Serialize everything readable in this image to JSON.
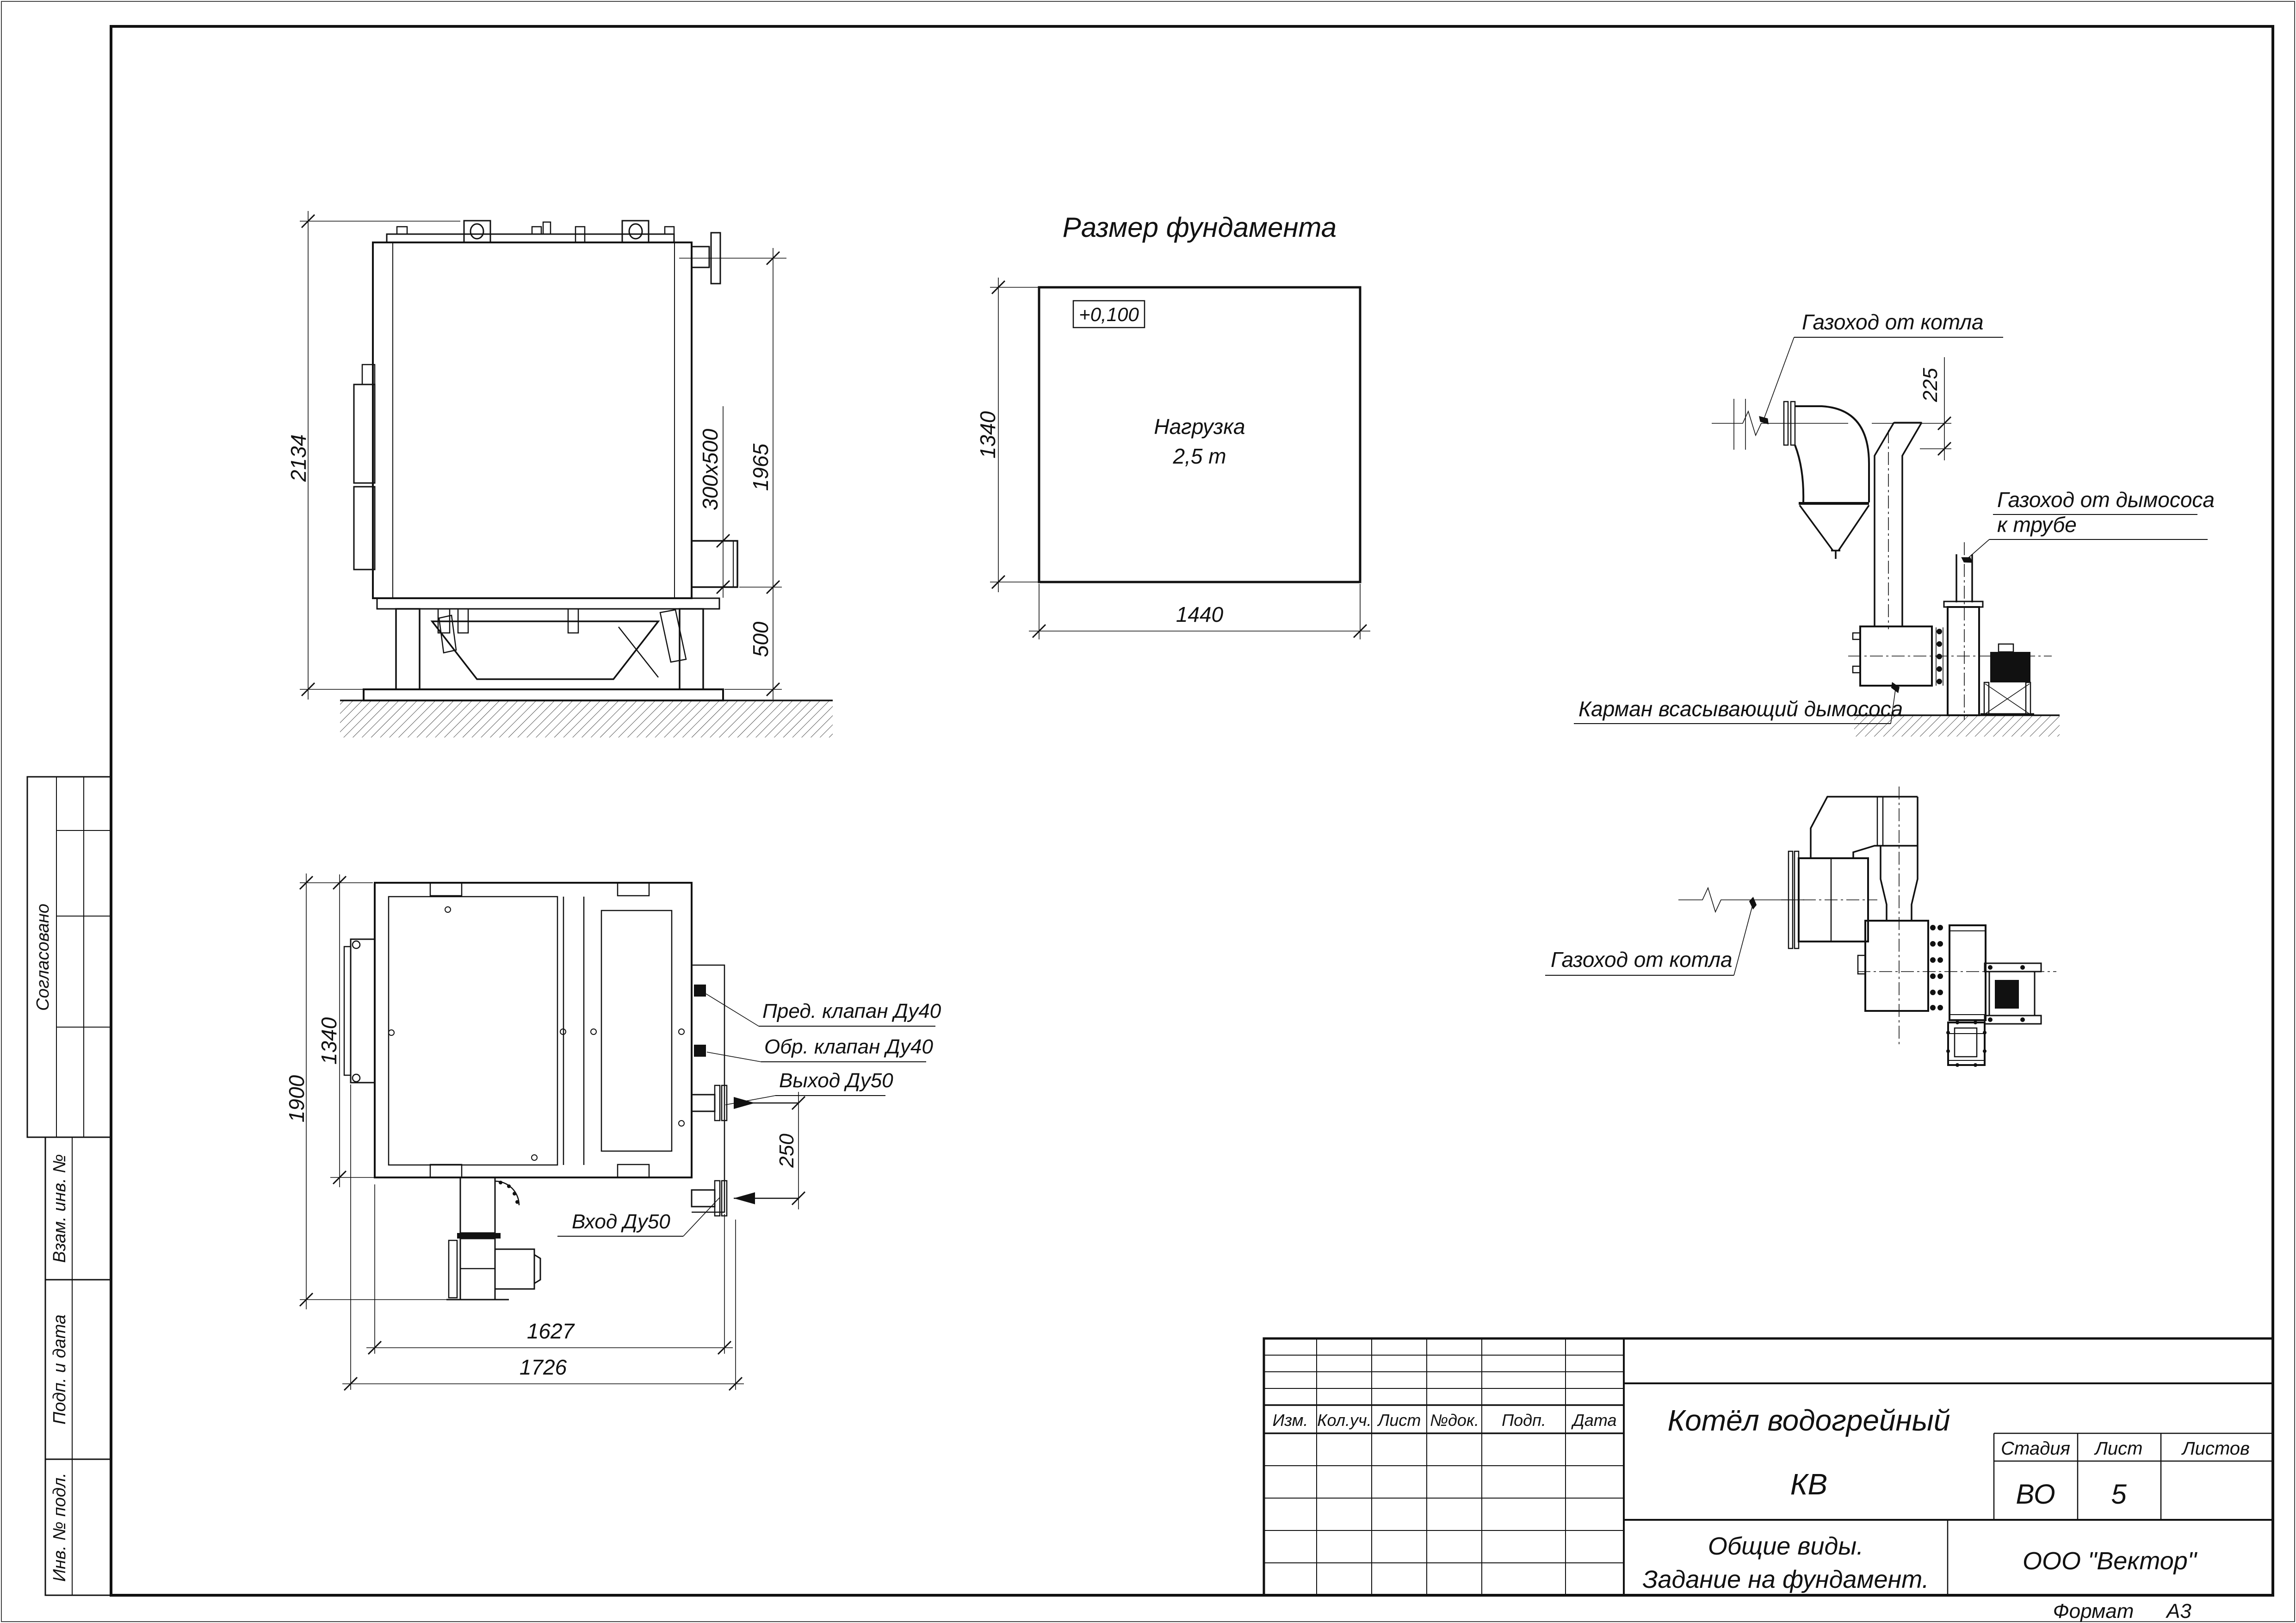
{
  "page": {
    "format_label": "Формат",
    "format_value": "А3"
  },
  "stamps_left": {
    "agreed": "Согласовано",
    "replace_inv": "Взам. инв. №",
    "sign_date": "Подп. и дата",
    "inv_number": "Инв. № подл."
  },
  "title_block": {
    "columns": [
      "Изм.",
      "Кол.уч.",
      "Лист",
      "№док.",
      "Подп.",
      "Дата"
    ],
    "doc_title_1": "Котёл водогрейный",
    "doc_title_2": "КВ",
    "stage_label": "Стадия",
    "sheet_label": "Лист",
    "sheets_label": "Листов",
    "stage_value": "ВО",
    "sheet_value": "5",
    "sheets_value": "",
    "subtitle_1": "Общие виды.",
    "subtitle_2": "Задание на фундамент.",
    "company": "ООО \"Вектор\""
  },
  "side_view": {
    "dim_height": "2134",
    "dim_flue": "300х500",
    "dim_right": "1965",
    "dim_base": "500"
  },
  "foundation_plan": {
    "title": "Размер фундамента",
    "level": "+0,100",
    "load_1": "Нагрузка",
    "load_2": "2,5 т",
    "dim_width": "1440",
    "dim_depth": "1340"
  },
  "flue_elevation": {
    "label_from_boiler": "Газоход от котла",
    "dim_offset": "225",
    "label_to_stack_1": "Газоход от дымососа",
    "label_to_stack_2": "к трубе",
    "label_pocket": "Карман всасывающий дымососа"
  },
  "flue_plan": {
    "label_from_boiler": "Газоход от котла"
  },
  "boiler_plan": {
    "dim_height": "1900",
    "dim_width_inner": "1340",
    "dim_len_1": "1627",
    "dim_len_2": "1726",
    "dim_pipes": "250",
    "label_safety_valve": "Пред. клапан Ду40",
    "label_check_valve": "Обр. клапан Ду40",
    "label_outlet": "Выход Ду50",
    "label_inlet": "Вход Ду50"
  }
}
